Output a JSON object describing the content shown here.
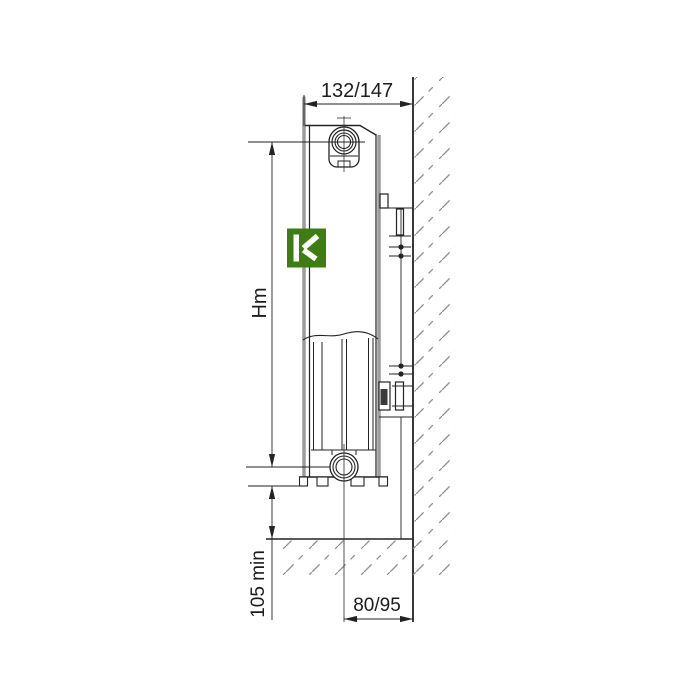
{
  "drawing": {
    "dimensions": {
      "depth_top": "132/147",
      "height": "Hm",
      "floor_clearance": "105 min",
      "pipe_to_wall": "80/95"
    },
    "logo": {
      "letter": "K",
      "color": "#3e7d11"
    },
    "colors": {
      "line": "#222222",
      "hatch": "#8f8f8f",
      "panel_gray": "#9c9c9c",
      "background": "#ffffff"
    }
  }
}
